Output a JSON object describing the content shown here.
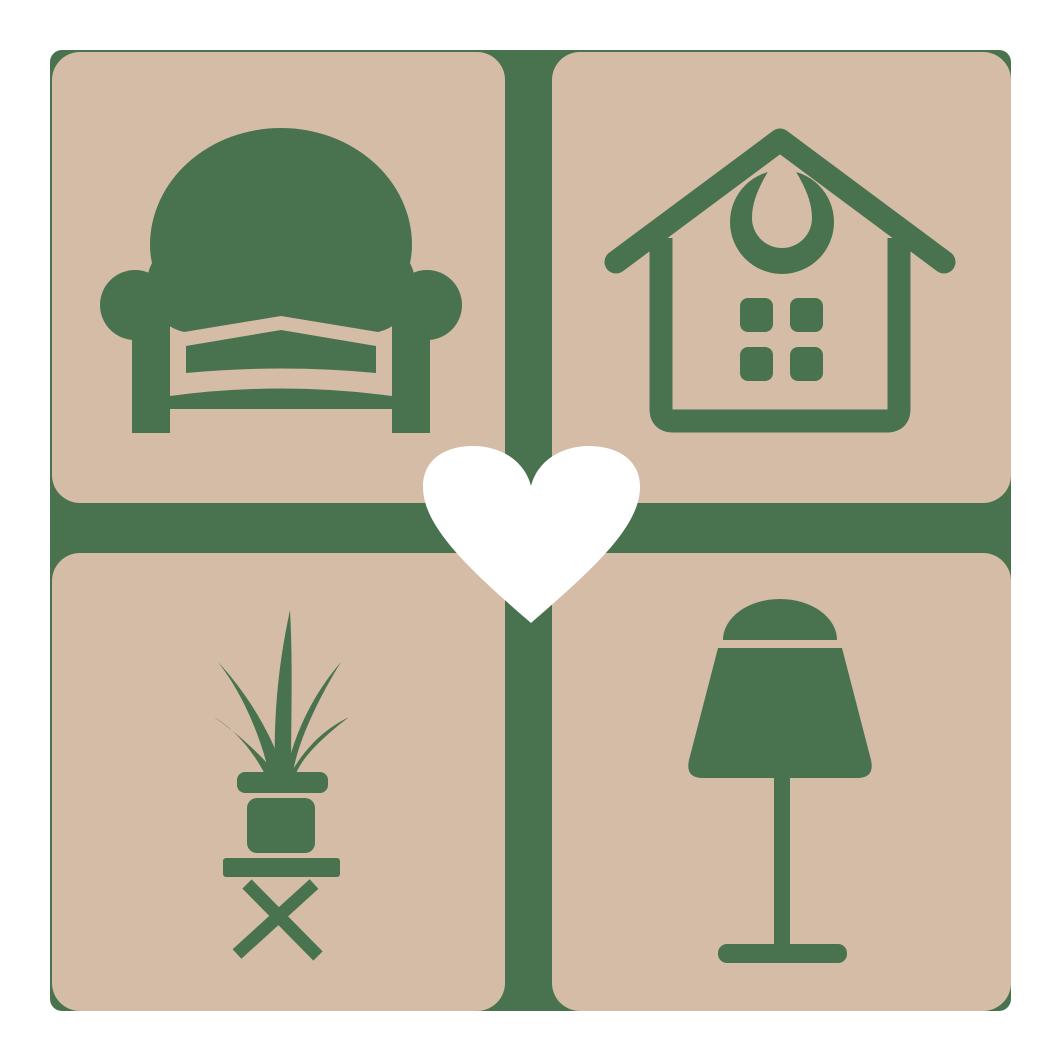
{
  "logo": {
    "name": "home-decor-heart-logo",
    "colors": {
      "page_background": "#ffffff",
      "grid": "#49734F",
      "tile": "#D4BCA6",
      "icon": "#49734F",
      "heart": "#ffffff"
    },
    "tiles": [
      {
        "id": "armchair",
        "icon_name": "armchair-icon",
        "position": "top-left"
      },
      {
        "id": "house",
        "icon_name": "house-icon",
        "position": "top-right"
      },
      {
        "id": "potted-plant",
        "icon_name": "potted-plant-icon",
        "position": "bottom-left"
      },
      {
        "id": "table-lamp",
        "icon_name": "table-lamp-icon",
        "position": "bottom-right"
      }
    ],
    "center_icon": "heart-icon"
  }
}
